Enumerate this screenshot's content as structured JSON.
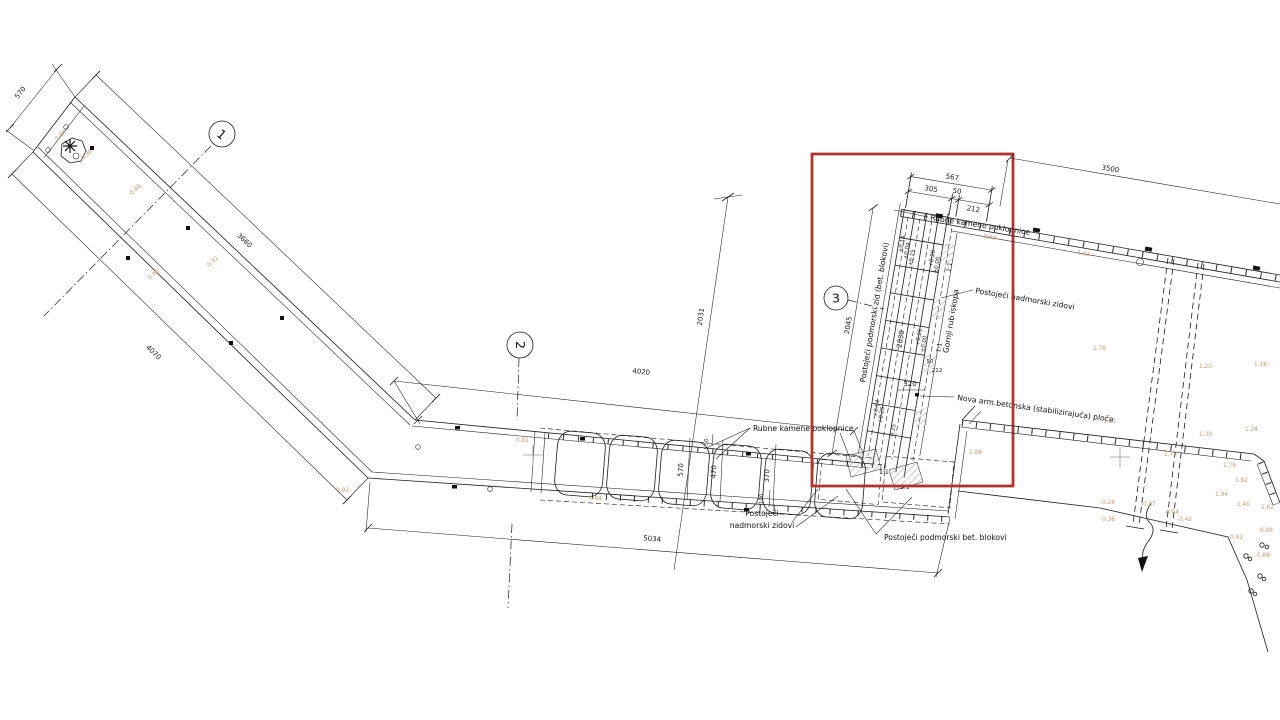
{
  "drawing_type": "site plan / technical CAD drawing",
  "detail_callout": {
    "color": "#b2342c"
  },
  "colors": {
    "line": "#1c1c1c",
    "spot_elevation": "#c69a6e",
    "hatch": "#9a9a9a"
  },
  "section_markers": {
    "m1": "1",
    "m2": "2",
    "m3": "3"
  },
  "dims": {
    "head_width": "570",
    "outer_side": "3660",
    "inner_side": "4070",
    "vertical_ext": "2031",
    "pier_top": "4020",
    "pier_bottom": "5034",
    "quay": "3500",
    "detail_left": "2045",
    "detail_inner": "2030",
    "detail_total": "567",
    "detail_a": "305",
    "detail_b": "50",
    "detail_c": "212",
    "detail_d": "50",
    "detail_e": "212",
    "detail_f": "320",
    "sec_570": "570",
    "sec_470": "470",
    "sec_370": "370",
    "sec_100": "100",
    "sec_50": "50"
  },
  "labels": {
    "rubne_top": "Rubne kamene poklopnice",
    "rubne_detail": "Rubne kamene poklopnice",
    "nadmorski_right": "Postojeći nadmorski zidovi",
    "postojeci_line1": "Postojeći",
    "postojeci_line2": "nadmorski zidovi",
    "podmorski_blokovi": "Postojeći podmorski bet. blokovi",
    "podmorski_zid": "Postojeći podmorski zid (bet. blokovi)",
    "gornji_rub": "Gornji rub iskopa",
    "nova_ploca": "Nova arm.betonska (stabilizirajuća) ploča"
  },
  "levels": {
    "l1": "+0.14",
    "l2": "+0.04",
    "l3": "+0.25",
    "l4": "+0.26",
    "l5": "±0.00",
    "l6": "+0.26",
    "l7": "±0.00",
    "l8": "+0.64",
    "l9": "+0.25",
    "l10": "-0.25"
  },
  "slopes": {
    "s1": "1:1",
    "s2": "1:1",
    "s3": "1:1",
    "s4": "1:1"
  },
  "spots": [
    "0.94",
    "0.98",
    "0.86",
    "0.92",
    "0.90",
    "0.93",
    "0.81",
    "0.84",
    "0.99",
    "1.21",
    "1.78",
    "1.20",
    "1.16",
    "1.31",
    "1.30",
    "1.24",
    "1.79",
    "1.82",
    "1.94",
    "1.40",
    "1.62",
    "0.98",
    "0.88",
    "0.43",
    "-0.37",
    "-0.04",
    "-0.42",
    "-0.28",
    "-0.36",
    "1.88",
    "1.75"
  ]
}
